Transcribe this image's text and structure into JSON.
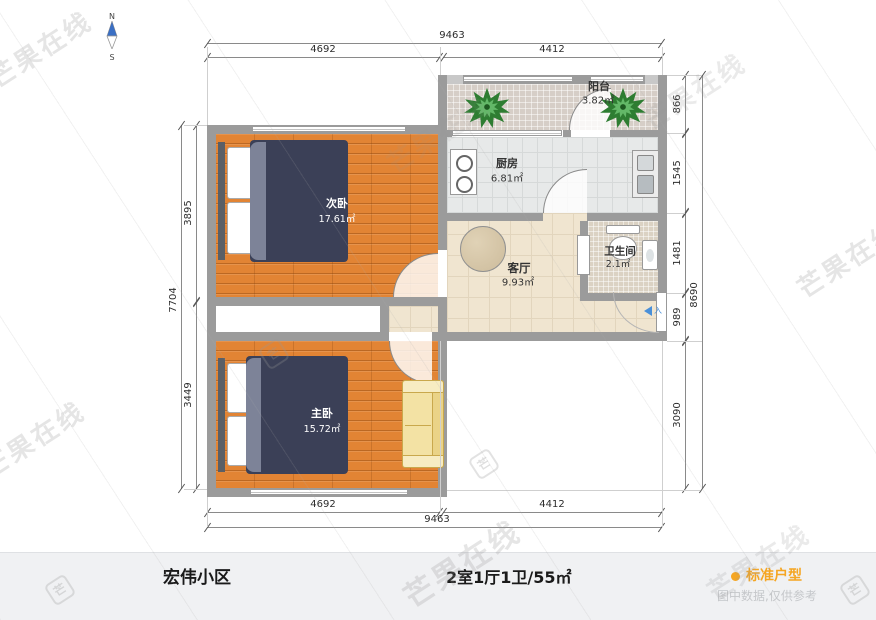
{
  "compass": {
    "north": "N",
    "south": "S"
  },
  "watermark": {
    "text": "芒果在线",
    "logo": "芒"
  },
  "rooms": {
    "balcony": {
      "name": "阳台",
      "area": "3.82㎡"
    },
    "kitchen": {
      "name": "厨房",
      "area": "6.81㎡"
    },
    "bathroom": {
      "name": "卫生间",
      "area": "2.1㎡"
    },
    "living": {
      "name": "客厅",
      "area": "9.93㎡"
    },
    "bedroom_second": {
      "name": "次卧",
      "area": "17.61㎡"
    },
    "bedroom_master": {
      "name": "主卧",
      "area": "15.72㎡"
    }
  },
  "entry": {
    "label": "入"
  },
  "dimensions": {
    "top": {
      "total": "9463",
      "left": "4692",
      "right": "4412"
    },
    "bottom": {
      "total": "9463",
      "left": "4692",
      "right": "4412"
    },
    "left": {
      "total": "7704",
      "upper": "3895",
      "lower": "3449"
    },
    "right": {
      "balcony": "866",
      "kitchen": "1545",
      "bathroom": "1481",
      "entry": "989",
      "lower": "3090",
      "total": "8690"
    }
  },
  "footer": {
    "community": "宏伟小区",
    "spec": "2室1厅1卫/55㎡",
    "tag": "标准户型",
    "disclaimer": "图中数据,仅供参考"
  },
  "colors": {
    "accent": "#f5a623",
    "wall": "#9b9b9b",
    "blanket": "#3b4057",
    "wood": "#e28434"
  }
}
